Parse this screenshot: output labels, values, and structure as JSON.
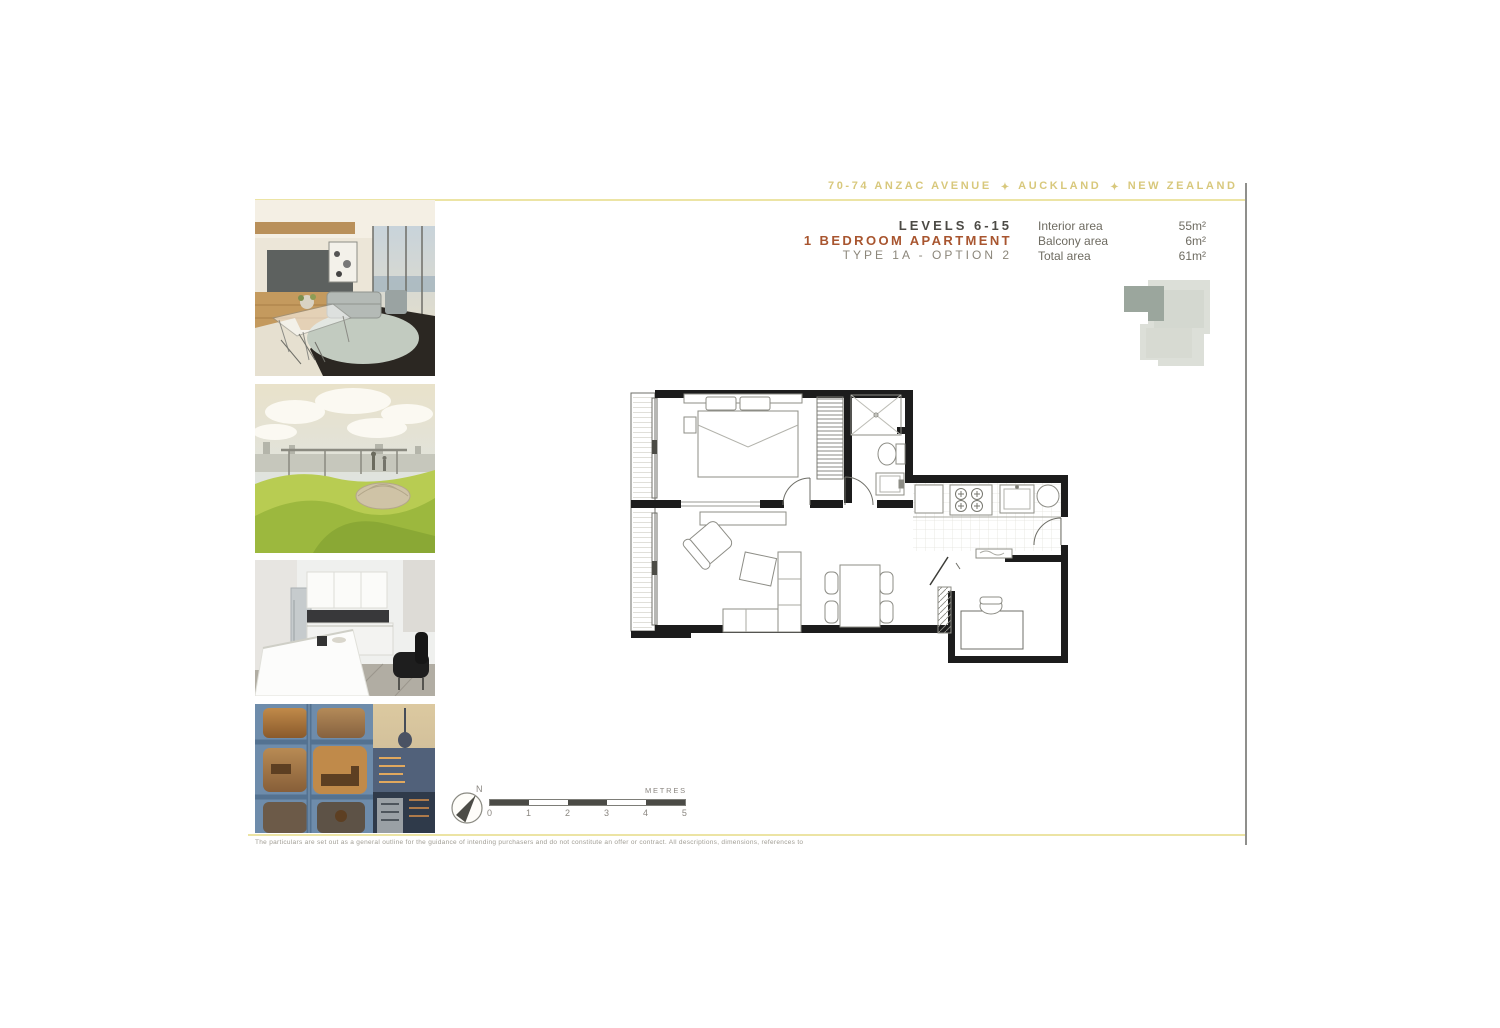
{
  "header": {
    "address": "70-74 ANZAC AVENUE",
    "city": "AUCKLAND",
    "country": "NEW ZEALAND",
    "separator_glyph": "✦",
    "text_color": "#d8c87c"
  },
  "title_block": {
    "levels": "LEVELS 6-15",
    "apartment": "1 BEDROOM APARTMENT",
    "type": "TYPE 1A - OPTION 2",
    "apartment_color": "#a8552f",
    "stats": [
      {
        "label": "Interior area",
        "value": "55m²"
      },
      {
        "label": "Balcony area",
        "value": "6m²"
      },
      {
        "label": "Total area",
        "value": "61m²"
      }
    ]
  },
  "photos": [
    {
      "name": "living-room-interior"
    },
    {
      "name": "rooftop-garden"
    },
    {
      "name": "kitchen-interior"
    },
    {
      "name": "building-exterior-dusk"
    }
  ],
  "locator": {
    "name": "floor-plate-key-plan",
    "highlight_color": "#9ba69d",
    "plate_color": "#dcdfd8"
  },
  "compass": {
    "north_label": "N"
  },
  "scale_bar": {
    "unit_label": "METRES",
    "ticks": [
      "0",
      "1",
      "2",
      "3",
      "4",
      "5"
    ]
  },
  "disclaimer": "The particulars are set out as a general outline for the guidance of intending purchasers and do not constitute an offer or contract. All descriptions, dimensions, references to",
  "accents": {
    "rule_color": "#ece4a4",
    "scan_edge_color": "#8f8f8c",
    "wall_color": "#1c1c1c"
  }
}
